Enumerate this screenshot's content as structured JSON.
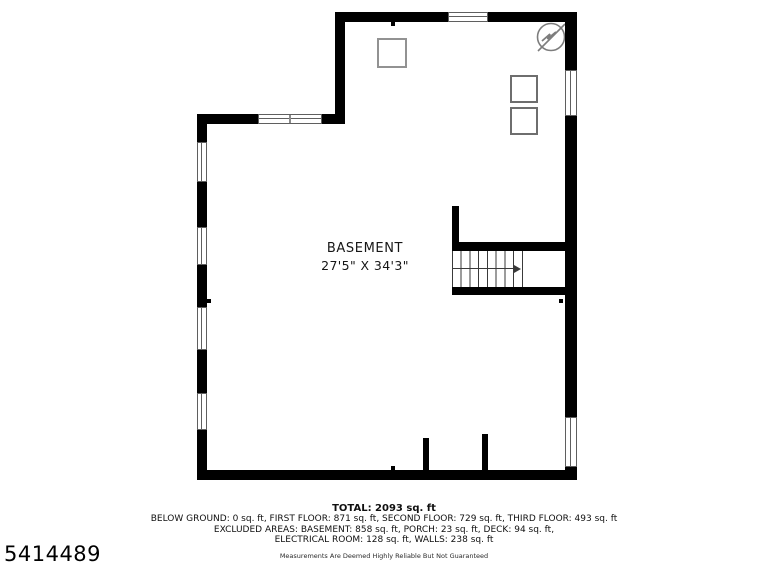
{
  "floor_plan": {
    "room": {
      "label": "BASEMENT",
      "dimensions": "27'5\" X 34'3\""
    },
    "icons": {
      "electrical_symbol": "circle-with-lightning-bolt"
    },
    "colors": {
      "wall": "#000000",
      "window_frame": "#5f5f5f",
      "furniture_outline": "#929292",
      "stair_lines": "#3a3a3a",
      "electrical_symbol": "#7d7d7d",
      "background": "#ffffff"
    }
  },
  "footer": {
    "total": "TOTAL: 2093 sq. ft",
    "floor_areas": "BELOW GROUND: 0 sq. ft, FIRST FLOOR: 871 sq. ft, SECOND FLOOR: 729 sq. ft, THIRD FLOOR: 493 sq. ft",
    "excluded_areas_line1": "EXCLUDED AREAS: BASEMENT: 858 sq. ft, PORCH: 23 sq. ft, DECK: 94 sq. ft,",
    "excluded_areas_line2": "ELECTRICAL ROOM: 128 sq. ft, WALLS: 238 sq. ft",
    "disclaimer": "Measurements Are Deemed Highly Reliable But Not Guaranteed"
  },
  "listing_id": "5414489"
}
